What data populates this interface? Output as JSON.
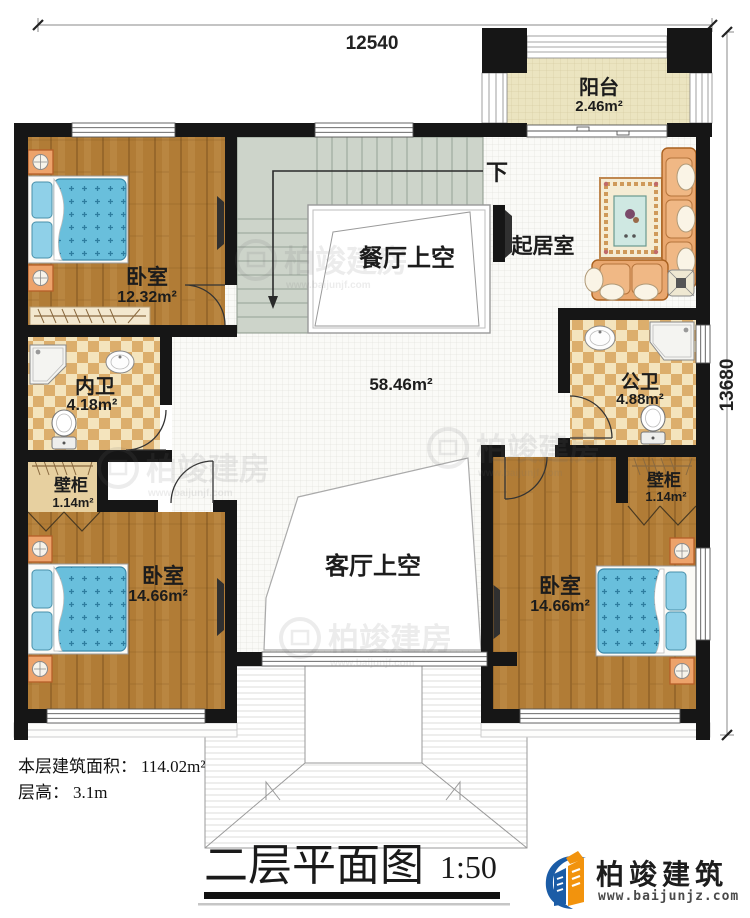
{
  "dimensions": {
    "top": "12540",
    "right": "13680"
  },
  "rooms": {
    "balcony": {
      "name": "阳台",
      "area": "2.46m²"
    },
    "living": {
      "name": "起居室"
    },
    "dining_void": {
      "name": "餐厅上空"
    },
    "living_void": {
      "name": "客厅上空"
    },
    "bedroom_top_left": {
      "name": "卧室",
      "area": "12.32m²"
    },
    "inner_bath": {
      "name": "内卫",
      "area": "4.18m²"
    },
    "public_bath": {
      "name": "公卫",
      "area": "4.88m²"
    },
    "closet_left": {
      "name": "壁柜",
      "area": "1.14m²"
    },
    "closet_right": {
      "name": "壁柜",
      "area": "1.14m²"
    },
    "bedroom_bottom_left": {
      "name": "卧室",
      "area": "14.66m²"
    },
    "bedroom_bottom_right": {
      "name": "卧室",
      "area": "14.66m²"
    },
    "hall": {
      "area": "58.46m²"
    },
    "stairs": {
      "direction": "下"
    }
  },
  "info": {
    "area_label": "本层建筑面积：",
    "area_value": "114.02m²",
    "height_label": "层高：",
    "height_value": "3.1m"
  },
  "title": {
    "name": "二层平面图",
    "scale": "1:50"
  },
  "brand": {
    "name": "柏竣建筑",
    "url": "www.baijunjz.com"
  },
  "watermark": {
    "name": "柏竣建房",
    "url": "www.baijunjf.com"
  },
  "colors": {
    "wall": "#161616",
    "wood_floor": "#b17c36",
    "tile_dark": "#dcae6c",
    "tile_light": "#f4e4bd",
    "stair": "#cdd4ca",
    "bed_blue": "#69bfdc",
    "sofa_tan": "#e9a76f",
    "brand_blue": "#1b5ca6",
    "brand_orange": "#f2930d"
  }
}
